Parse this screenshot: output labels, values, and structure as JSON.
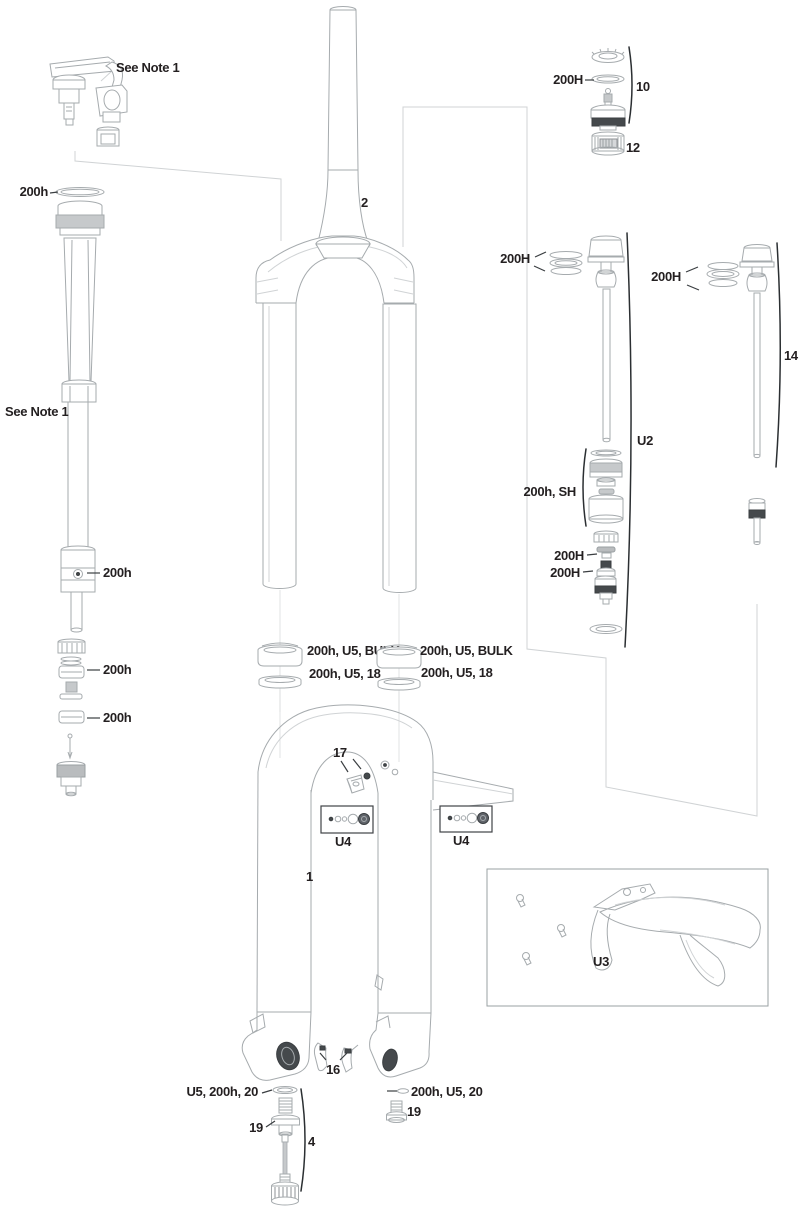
{
  "diagram": {
    "kind": "exploded-parts-diagram",
    "subject": "suspension-fork",
    "colors": {
      "background": "#ffffff",
      "line": "#a6abae",
      "leader_light": "#d0d3d5",
      "dark_part": "#45494c",
      "gray_band": "#c6c9cb",
      "text": "#231f20"
    },
    "labels": {
      "note_top": "See Note 1",
      "note_left": "See Note 1",
      "steerer_tube": "2",
      "lower_leg_assembly": "1",
      "crown_race_seal": "200h",
      "damper_body": "200h",
      "damper_seal_upper": "200h",
      "damper_seal_lower": "200h",
      "dust_seal_left": "200h, U5, BULK",
      "foam_ring_left": "200h, U5, 18",
      "dust_seal_right": "200h, U5, BULK",
      "foam_ring_right": "200h, U5, 18",
      "hose_guide": "17",
      "fastener_kit_left": "U4",
      "fastener_kit_right": "U4",
      "top_cap_assembly": "10",
      "top_cap_seal": "200H",
      "adjuster_knob": "12",
      "air_top_seals": "200H",
      "air_shaft_assembly": "U2",
      "shaft14_seals": "200H",
      "shaft14_assembly": "14",
      "seal_head": "200h, SH",
      "air_piston_seal_upper": "200H",
      "air_piston_seal_lower": "200H",
      "fender_kit": "U3",
      "cable_guide_clips": "16",
      "crush_washer_left": "U5, 200h, 20",
      "shaft_bolt_left": "19",
      "rebound_adjuster_assembly": "4",
      "crush_washer_right": "200h, U5, 20",
      "shaft_bolt_right": "19"
    }
  }
}
